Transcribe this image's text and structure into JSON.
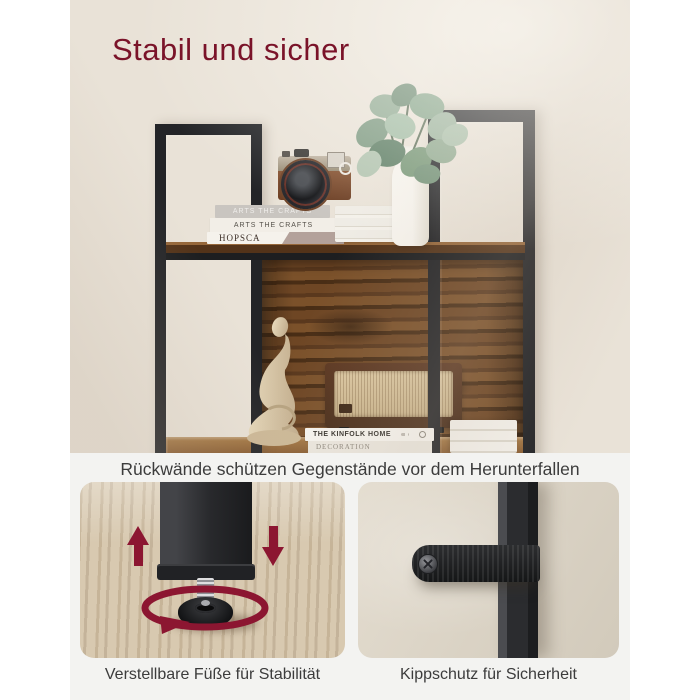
{
  "title": "Stabil und sicher",
  "main_caption": "Rückwände schützen Gegenstände vor dem Herunterfallen",
  "features": {
    "feet": {
      "caption": "Verstellbare Füße für Stabilität"
    },
    "antitip": {
      "caption": "Kippschutz für Sicherheit"
    }
  },
  "photo": {
    "books": [
      "ARTS THE CRAFTS",
      "ARTS THE CRAFTS",
      "HOPSCA",
      "THE KINFOLK HOME",
      "DECORATION"
    ],
    "props": [
      "vintage camera",
      "book stack",
      "eucalyptus plant in white vase",
      "abstract thinker sculpture",
      "vintage radio",
      "white books"
    ]
  },
  "icons": {
    "up_arrow": "▲",
    "down_arrow": "▼",
    "rotate_arrow": "↻"
  },
  "colors": {
    "accent_red": "#7a1329",
    "arrow_red": "#8c1631",
    "metal_black": "#232427",
    "rustic_brown": "#5e3a1e",
    "wall_beige": "#e9e2d7",
    "section_gray": "#f3f3f1",
    "caption_gray": "#3c3c3c"
  }
}
